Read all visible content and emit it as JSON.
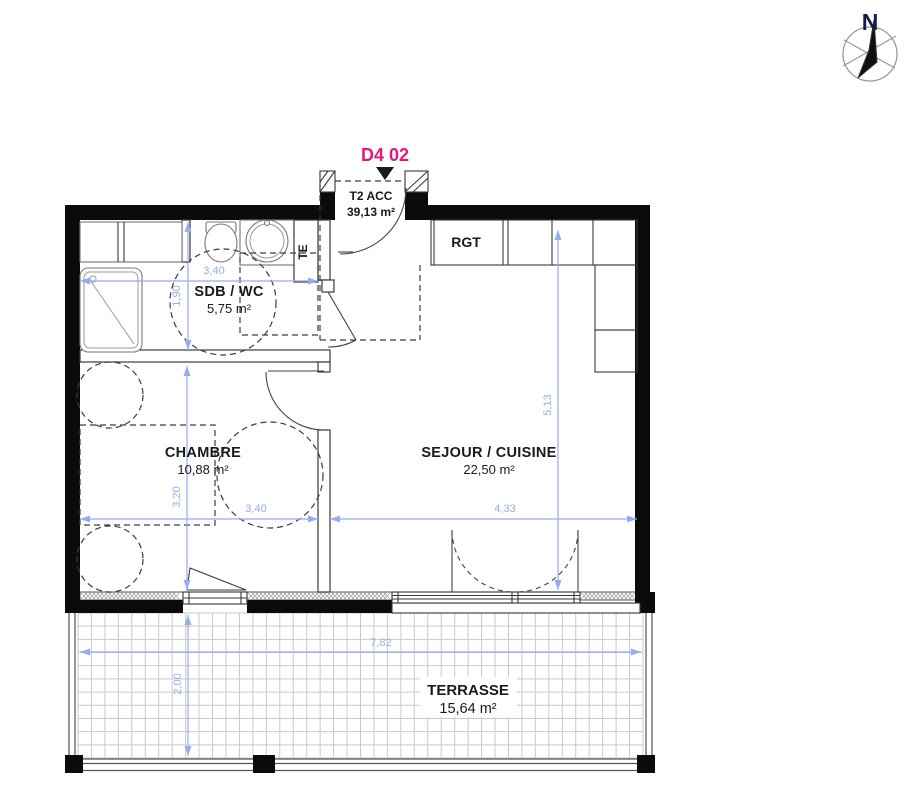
{
  "compass": {
    "north": "N"
  },
  "unit": {
    "code": "D4 02"
  },
  "entry": {
    "label": "T2 ACC",
    "area": "39,13 m²"
  },
  "storage": {
    "rgt": "RGT",
    "te": "TE"
  },
  "rooms": {
    "sdb": {
      "name": "SDB / WC",
      "area": "5,75 m²"
    },
    "chambre": {
      "name": "CHAMBRE",
      "area": "10,88 m²"
    },
    "sejour": {
      "name": "SEJOUR / CUISINE",
      "area": "22,50 m²"
    },
    "terrasse": {
      "name": "TERRASSE",
      "area": "15,64 m²"
    }
  },
  "dimensions": {
    "sdb_width": "3,40",
    "sdb_height": "1,90",
    "chambre_width": "3,40",
    "chambre_height": "3,20",
    "sejour_width": "4,33",
    "sejour_height": "5,13",
    "terrasse_width": "7,82",
    "terrasse_height": "2,00"
  },
  "colors": {
    "unit_label": "#e3187c",
    "dimension": "#97abef",
    "wall": "#0b0b0b"
  }
}
